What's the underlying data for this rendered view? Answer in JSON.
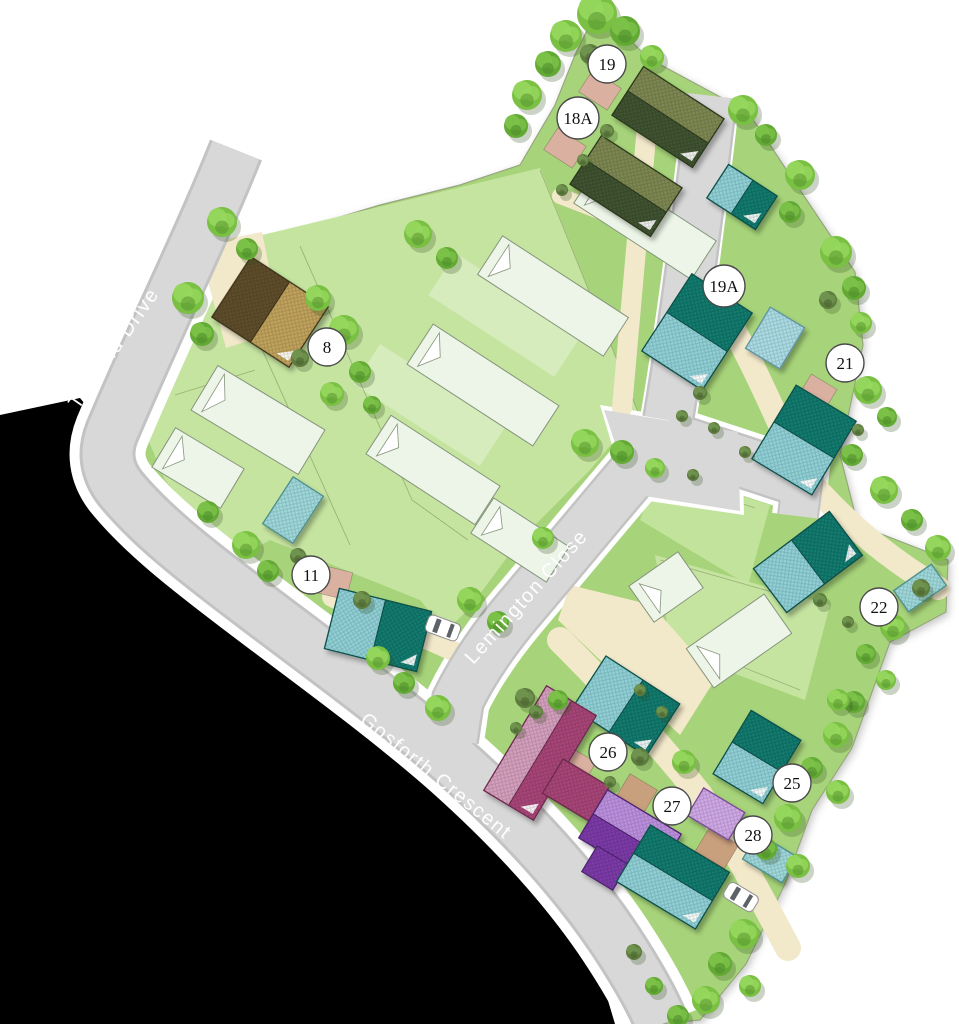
{
  "streets": [
    {
      "name": "Tanfield Drive"
    },
    {
      "name": "Lemington Close"
    },
    {
      "name": "Gosforth Crescent"
    }
  ],
  "plots": [
    {
      "label": "19",
      "x": 607,
      "y": 64
    },
    {
      "label": "18A",
      "x": 578,
      "y": 118
    },
    {
      "label": "8",
      "x": 327,
      "y": 347
    },
    {
      "label": "19A",
      "x": 724,
      "y": 286
    },
    {
      "label": "21",
      "x": 845,
      "y": 363
    },
    {
      "label": "22",
      "x": 879,
      "y": 607
    },
    {
      "label": "11",
      "x": 311,
      "y": 575
    },
    {
      "label": "26",
      "x": 608,
      "y": 752
    },
    {
      "label": "27",
      "x": 672,
      "y": 806
    },
    {
      "label": "25",
      "x": 792,
      "y": 783
    },
    {
      "label": "28",
      "x": 753,
      "y": 835
    }
  ],
  "colors": {
    "road": "#d8d8d8",
    "grass": "#a7d47a",
    "garden_light": "#c5e4a0",
    "path_beige": "#f2e8ca",
    "teal_dark": "#127a6e",
    "teal_light": "#8fd0d6",
    "olive_dark": "#3f5230",
    "magenta": "#a84578",
    "purple": "#7b3aa8",
    "badge_fill": "#ffffff"
  }
}
